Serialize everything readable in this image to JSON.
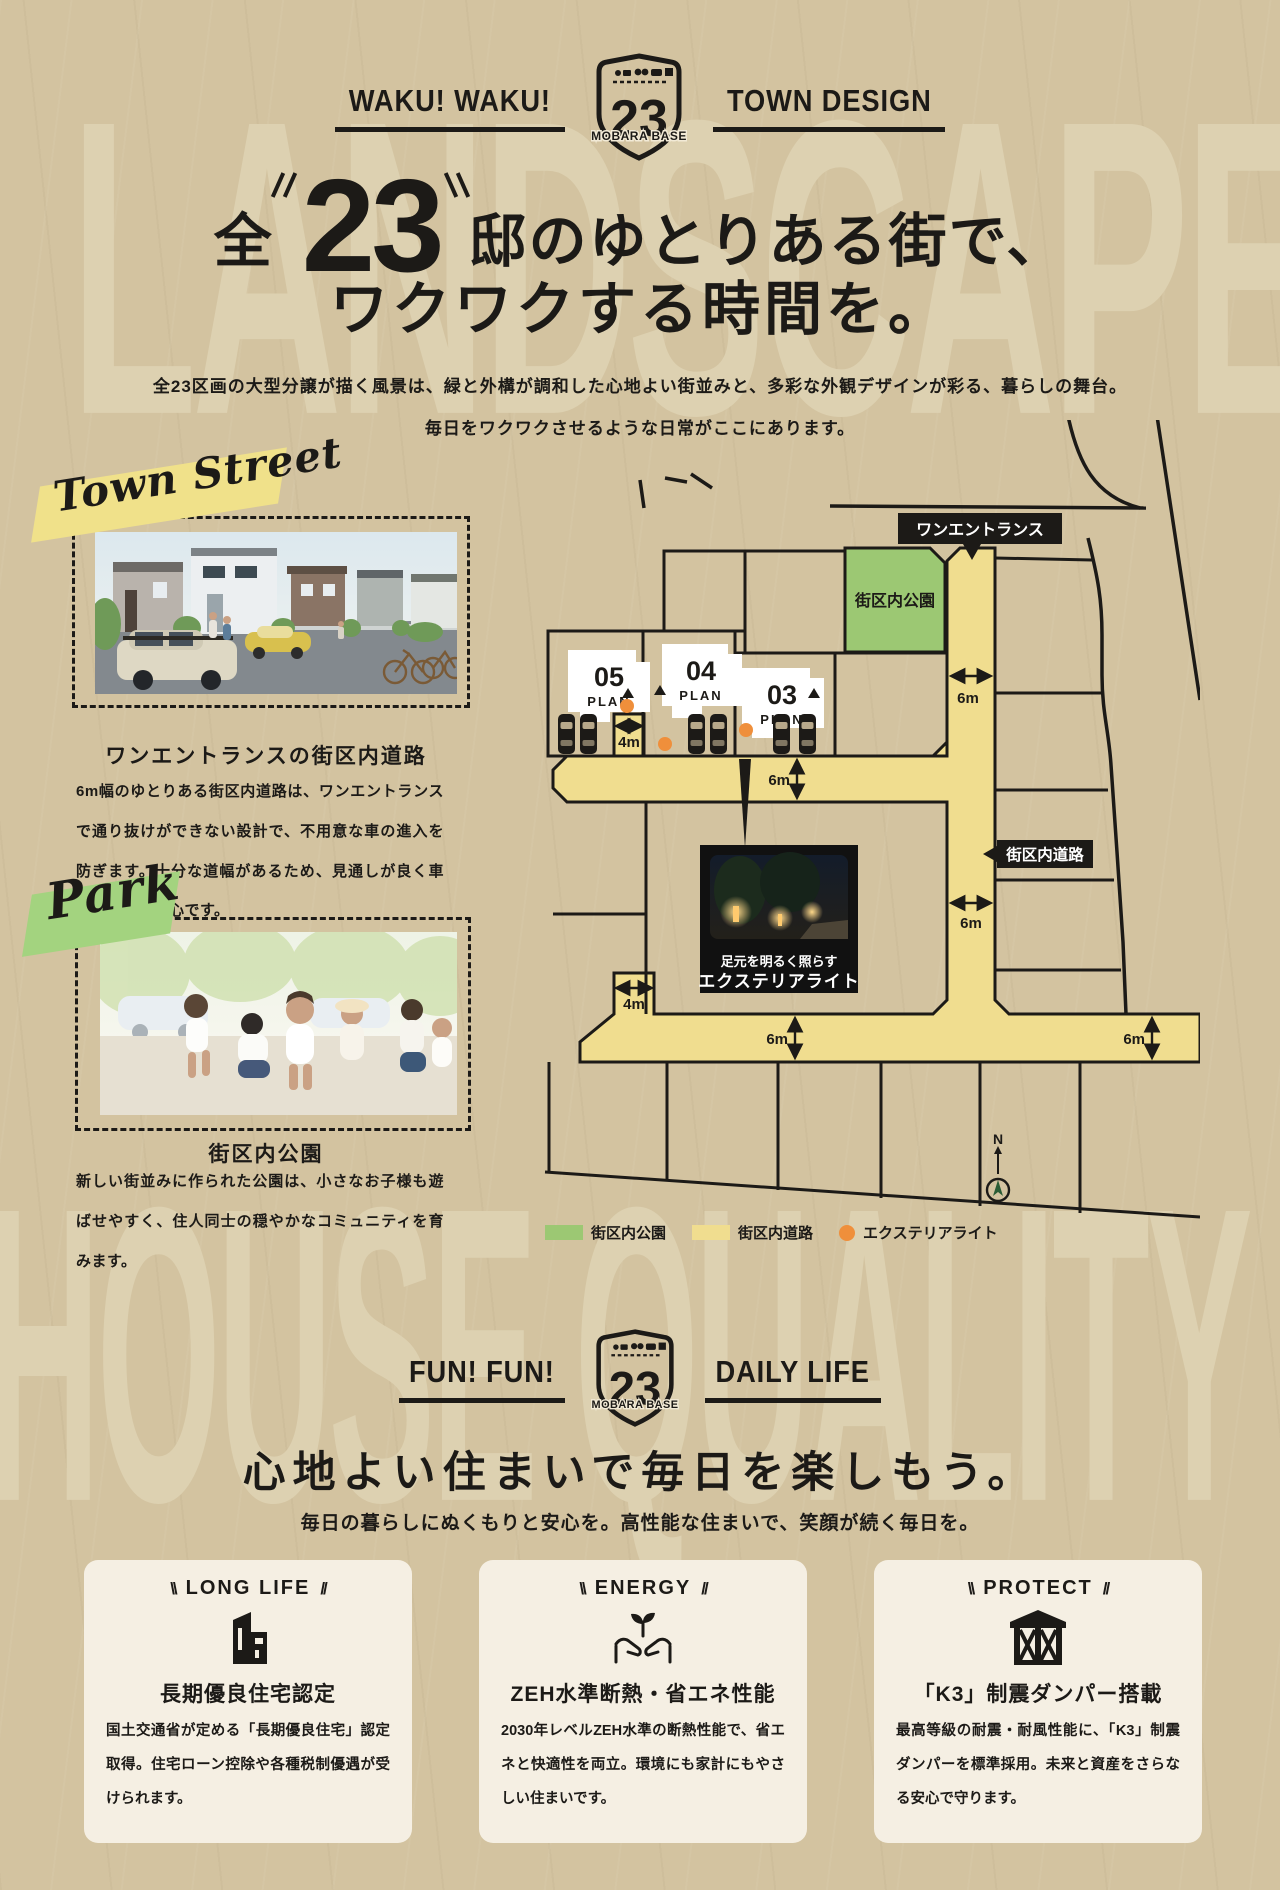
{
  "colors": {
    "background": "#d3c3a0",
    "ink": "#1c1a17",
    "road_yellow": "#f0dd8f",
    "park_green": "#9cc873",
    "light_orange": "#ef8f3b",
    "card_cream": "#f5efe3",
    "ribbon_yellow": "#f0e18a",
    "ribbon_green": "#a3d37f"
  },
  "watermarks": {
    "top": "LANDSCAPE",
    "bottom": "HOUSE QUALITY"
  },
  "shield": {
    "number": "23",
    "name": "MOBARA BASE"
  },
  "badge_top": {
    "left": "WAKU! WAKU!",
    "right": "TOWN DESIGN"
  },
  "hero": {
    "title_pre": "全",
    "title_num": "23",
    "title_post": "邸のゆとりある街で、",
    "title_line2": "ワクワクする時間を。",
    "intro_line1": "全23区画の大型分譲が描く風景は、緑と外構が調和した心地よい街並みと、多彩な外観デザインが彩る、暮らしの舞台。",
    "intro_line2": "毎日をワクワクさせるような日常がここにあります。"
  },
  "town_street": {
    "ribbon": "Town Street",
    "heading": "ワンエントランスの街区内道路",
    "body": "6m幅のゆとりある街区内道路は、ワンエントランスで通り抜けができない設計で、不用意な車の進入を防ぎます。十分な道幅があるため、見通しが良く車の出入りも安心です。"
  },
  "park": {
    "ribbon": "Park",
    "heading": "街区内公園",
    "body": "新しい街並みに作られた公園は、小さなお子様も遊ばせやすく、住人同士の穏やかなコミュニティを育みます。"
  },
  "map": {
    "labels": {
      "one_entrance": "ワンエントランス",
      "park": "街区内公園",
      "road": "街区内道路",
      "light_caption1": "足元を明るく照らす",
      "light_caption2": "エクステリアライト"
    },
    "plans": [
      {
        "num": "05",
        "word": "PLAN"
      },
      {
        "num": "04",
        "word": "PLAN"
      },
      {
        "num": "03",
        "word": "PLAN"
      }
    ],
    "dims": {
      "road6_top": "6m",
      "road6_mid": "6m",
      "road6_lower": "6m",
      "road6_bottom": "6m",
      "road6_bottom_right": "6m",
      "stub4_top": "4m",
      "stub4_bottom": "4m"
    },
    "legend": [
      {
        "label": "街区内公園"
      },
      {
        "label": "街区内道路"
      },
      {
        "label": "エクステリアライト"
      }
    ],
    "compass": "N"
  },
  "badge_daily": {
    "left": "FUN! FUN!",
    "right": "DAILY LIFE"
  },
  "daily": {
    "heading": "心地よい住まいで毎日を楽しもう。",
    "sub": "毎日の暮らしにぬくもりと安心を。高性能な住まいで、笑顔が続く毎日を。"
  },
  "cards": [
    {
      "mark_left": "\\\\",
      "mark_right": "//",
      "tag": "LONG LIFE",
      "icon": "house-icon",
      "title": "長期優良住宅認定",
      "body": "国土交通省が定める「長期優良住宅」認定取得。住宅ローン控除や各種税制優遇が受けられます。"
    },
    {
      "mark_left": "\\\\",
      "mark_right": "//",
      "tag": "ENERGY",
      "icon": "eco-hands-icon",
      "title": "ZEH水準断熱・省エネ性能",
      "body": "2030年レベルZEH水準の断熱性能で、省エネと快適性を両立。環境にも家計にもやさしい住まいです。"
    },
    {
      "mark_left": "\\\\",
      "mark_right": "//",
      "tag": "PROTECT",
      "icon": "damper-house-icon",
      "title": "「K3」制震ダンパー搭載",
      "body": "最高等級の耐震・耐風性能に、「K3」制震ダンパーを標準採用。未来と資産をさらなる安心で守ります。"
    }
  ]
}
